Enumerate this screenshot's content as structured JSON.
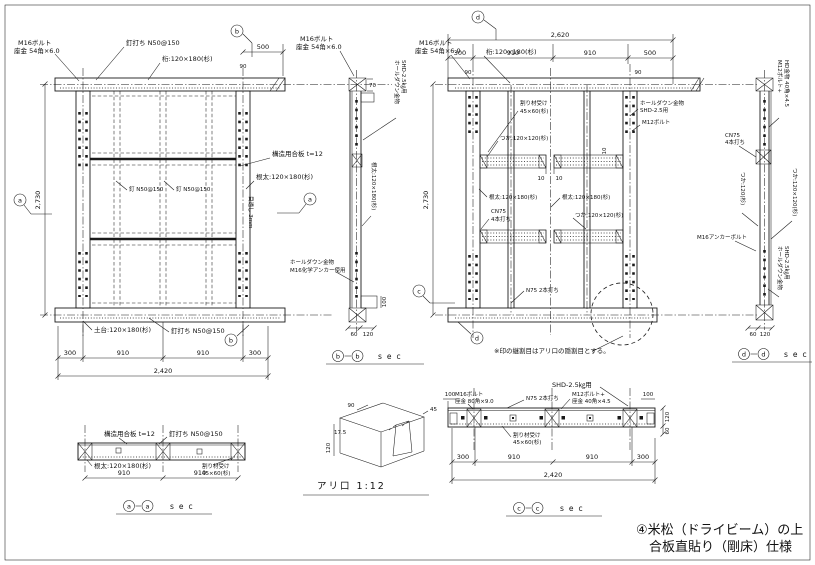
{
  "sheet": {
    "footer_line1": "④米松（ドライビーム）の上",
    "footer_line2": "合板直貼り（剛床）仕様",
    "colors": {
      "ink": "#1a1a1a",
      "paper": "#ffffff"
    }
  },
  "plan_left": {
    "marker_side": "a",
    "marker_cut": "b",
    "label_m16_1": "M16ボルト",
    "label_m16_2": "座金 54角×6.0",
    "label_nail_top": "釘打ち N50@150",
    "label_girder": "桁:120×180(杉)",
    "dim_500": "500",
    "dim_90": "90",
    "dim_height": "2,730",
    "label_plywood": "構造用合板 t=12",
    "label_joist": "根太:120×180(杉)",
    "label_gap": "目透し 3mm",
    "label_nail_mid_l": "釘 N50@150",
    "label_nail_mid_r": "釘 N50@150",
    "label_sill": "土台:120×180(杉)",
    "label_nail_bottom": "釘打ち N50@150",
    "dims_bottom": [
      "300",
      "910",
      "910",
      "300"
    ],
    "dim_total": "2,420"
  },
  "sec_b": {
    "letter": "b",
    "sec_word": "sec",
    "label_m16_1": "M16ボルト",
    "label_m16_2": "座金 54角×6.0",
    "dim_70": "70",
    "label_hd_1": "ホールダウン金物",
    "label_hd_2": "SHD-2.5㎏用",
    "label_member": "根太:120×180(杉)",
    "label_anchor_1": "ホールダウン金物",
    "label_anchor_2": "M16化学アンカー使用",
    "dim_100": "100",
    "dim_60": "60",
    "dim_120": "120"
  },
  "elev_right": {
    "marker_side": "c",
    "marker_cut": "d",
    "dim_total_top": "2,620",
    "dims_top": [
      "300",
      "910",
      "910",
      "500"
    ],
    "dim_90_l": "90",
    "dim_90_r": "90",
    "label_m16_1": "M16ボルト",
    "label_m16_2": "座金 54角×6.0",
    "label_girder": "桁:120×180(杉)",
    "dim_height": "2,730",
    "label_uke_1": "割り材受け",
    "label_uke_2": "45×60(杉)",
    "label_tsuka_1": "つか:120×120(杉)",
    "dim_10_a": "10",
    "dim_10_b": "10",
    "dim_10_c": "10",
    "label_joist_l": "根太:120×180(杉)",
    "label_joist_c": "根太:120×180(杉)",
    "label_cn75_1": "CN75",
    "label_cn75_2": "4本打ち",
    "label_tsuka_2": "つか:120×120(杉)",
    "label_n75": "N75 2本打ち",
    "label_hd_1": "ホールダウン金物",
    "label_hd_2": "SHD-2.5用",
    "label_m12": "M12ボルト",
    "note": "※印の継割目はアリ口の隠割目とする。"
  },
  "sec_d": {
    "letter": "d",
    "sec_word": "sec",
    "label_m12_1": "M12ボルト+",
    "label_m12_2": "HD金物 40角×4.5",
    "label_cn75_1": "CN75",
    "label_cn75_2": "4本打ち",
    "label_tsuka_v": "つか:120(杉)",
    "label_member_v": "つか:120×120(杉)",
    "label_anchor": "M16アンカーボルト",
    "label_hd_1": "ホールダウン金物",
    "label_hd_2": "SHD-2.5㎏用",
    "dim_60": "60",
    "dim_120": "120"
  },
  "sec_a": {
    "letter": "a",
    "sec_word": "sec",
    "label_plywood": "構造用合板 t=12",
    "label_nail": "釘打ち N50@150",
    "label_joist": "根太:120×180(杉)",
    "label_uke_1": "割り材受け",
    "label_uke_2": "45×60(杉)",
    "dim_l": "910",
    "dim_r": "910"
  },
  "detail_ari": {
    "title": "アリ口 1:12",
    "dim_90": "90",
    "dim_175": "17.5",
    "dim_120": "120",
    "dim_45": "45"
  },
  "sec_c": {
    "letter": "c",
    "sec_word": "sec",
    "label_shd": "SHD-2.5㎏用",
    "label_m16_1": "M16ボルト",
    "label_m16_2": "座金 80角×9.0",
    "label_n75": "N75 2本打ち",
    "label_m12_1": "M12ボルト+",
    "label_m12_2": "座金 40角×4.5",
    "dim_100_l": "100",
    "dim_100_r": "100",
    "label_uke_1": "割り材受け",
    "label_uke_2": "45×60(杉)",
    "dim_120": "120",
    "dim_60": "60",
    "dims_bottom": [
      "300",
      "910",
      "910",
      "300"
    ],
    "dim_total": "2,420"
  }
}
